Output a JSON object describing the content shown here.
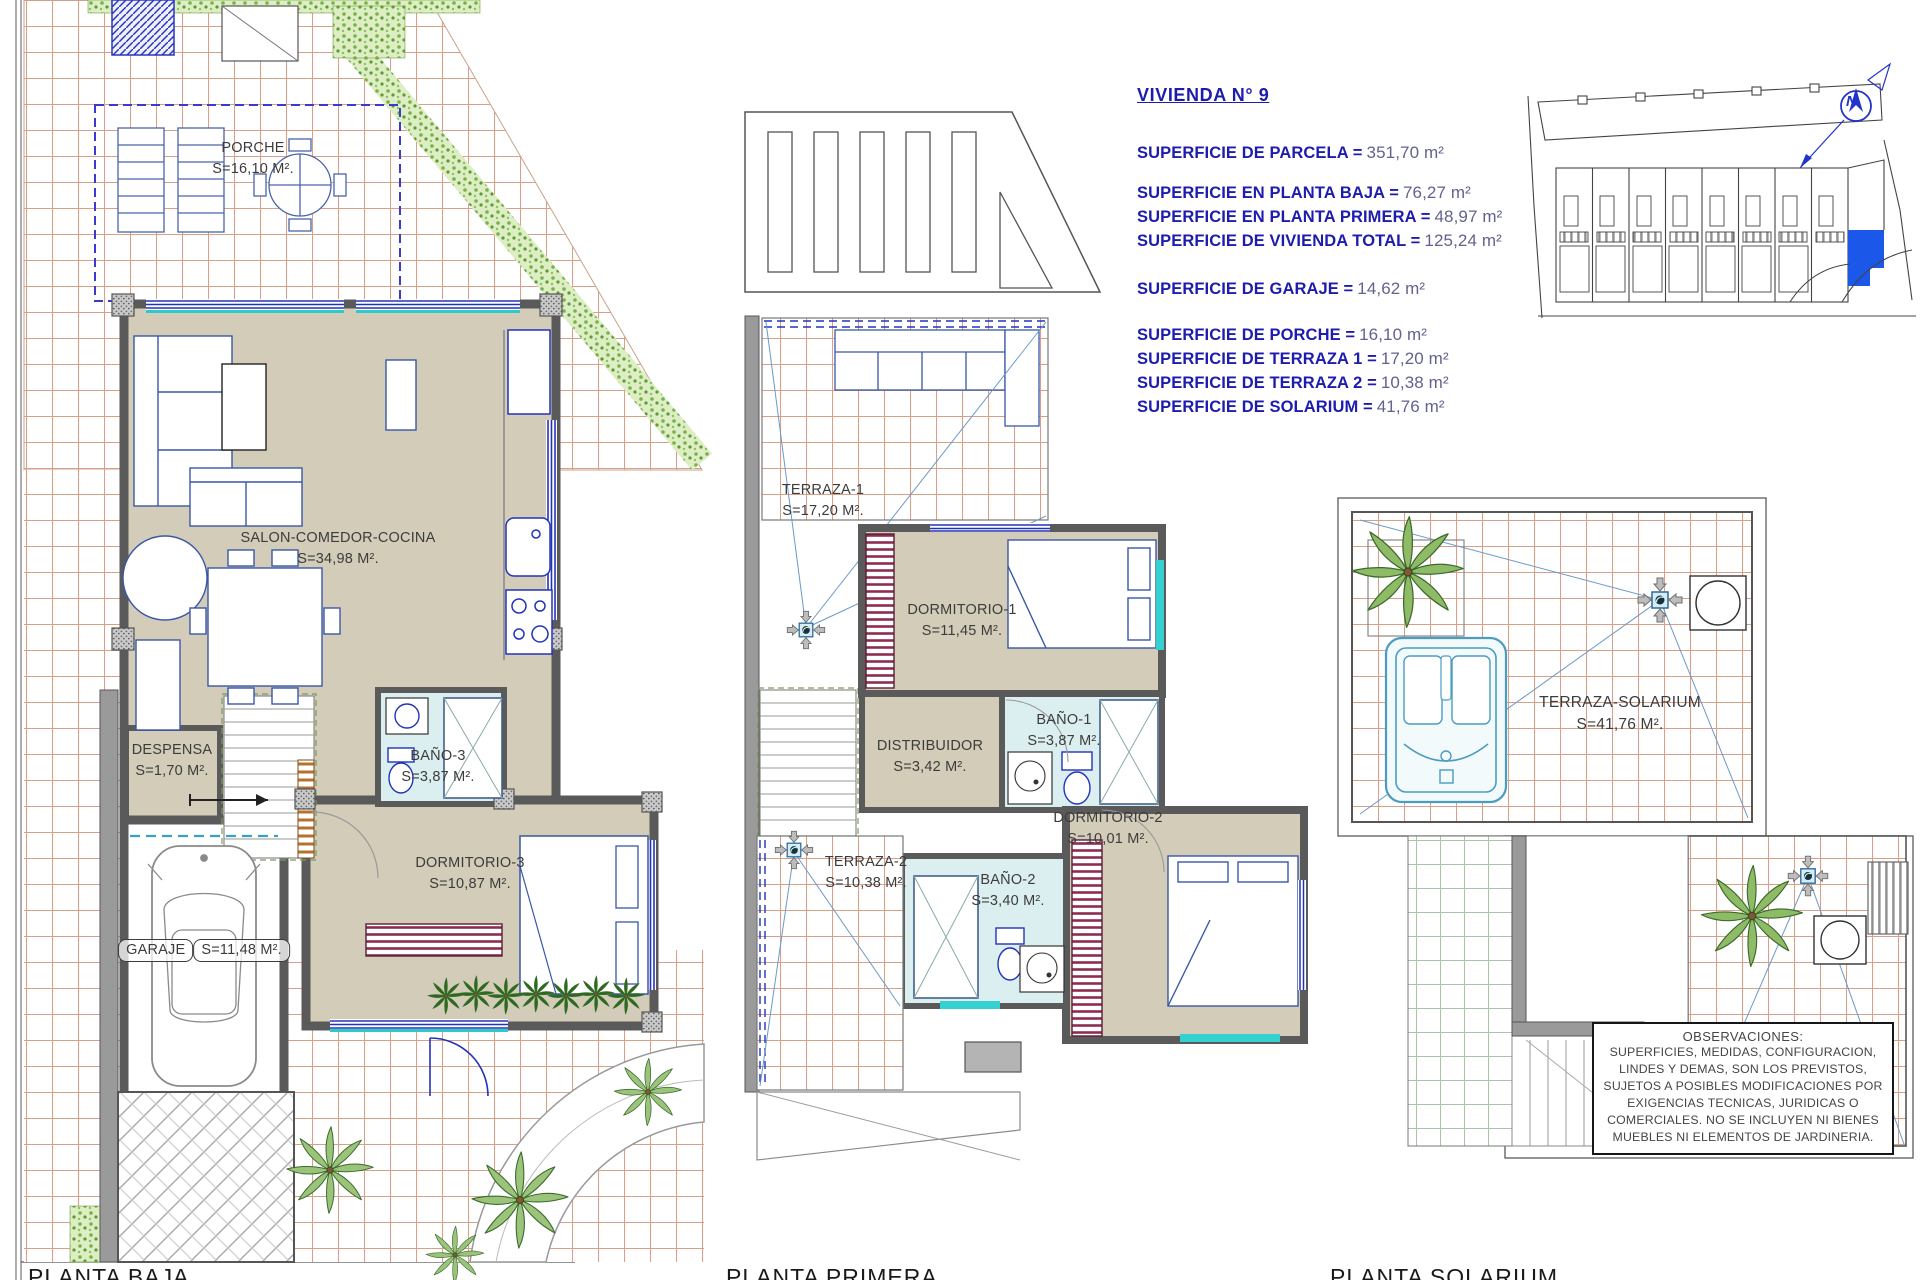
{
  "title_block": {
    "title": "VIVIENDA N° 9",
    "rows": [
      {
        "label": "SUPERFICIE DE PARCELA =",
        "value": "351,70 m²"
      },
      {
        "label": "SUPERFICIE EN PLANTA BAJA =",
        "value": "76,27 m²"
      },
      {
        "label": "SUPERFICIE EN PLANTA PRIMERA =",
        "value": "48,97 m²"
      },
      {
        "label": "SUPERFICIE DE VIVIENDA TOTAL =",
        "value": "125,24 m²"
      },
      {
        "label": "SUPERFICIE DE GARAJE =",
        "value": "14,62 m²"
      },
      {
        "label": "SUPERFICIE DE PORCHE =",
        "value": "16,10 m²"
      },
      {
        "label": "SUPERFICIE DE TERRAZA 1 =",
        "value": "17,20 m²"
      },
      {
        "label": "SUPERFICIE DE TERRAZA 2 =",
        "value": "10,38 m²"
      },
      {
        "label": "SUPERFICIE DE SOLARIUM =",
        "value": "41,76 m²"
      }
    ]
  },
  "plans": {
    "baja": {
      "caption": "PLANTA BAJA",
      "rooms": [
        {
          "name": "PORCHE",
          "area": "S=16,10 M²."
        },
        {
          "name": "SALON-COMEDOR-COCINA",
          "area": "S=34,98 M²."
        },
        {
          "name": "DESPENSA",
          "area": "S=1,70 M²."
        },
        {
          "name": "BAÑO-3",
          "area": "S=3,87 M²."
        },
        {
          "name": "DORMITORIO-3",
          "area": "S=10,87 M²."
        },
        {
          "name": "GARAJE",
          "area": "S=11,48 M²."
        }
      ]
    },
    "primera": {
      "caption": "PLANTA PRIMERA",
      "rooms": [
        {
          "name": "TERRAZA-1",
          "area": "S=17,20 M²."
        },
        {
          "name": "DORMITORIO-1",
          "area": "S=11,45 M²."
        },
        {
          "name": "DISTRIBUIDOR",
          "area": "S=3,42 M²."
        },
        {
          "name": "BAÑO-1",
          "area": "S=3,87 M²."
        },
        {
          "name": "DORMITORIO-2",
          "area": "S=10,01 M²."
        },
        {
          "name": "TERRAZA-2",
          "area": "S=10,38 M²."
        },
        {
          "name": "BAÑO-2",
          "area": "S=3,40 M²."
        }
      ]
    },
    "solarium": {
      "caption": "PLANTA SOLARIUM",
      "rooms": [
        {
          "name": "TERRAZA-SOLARIUM",
          "area": "S=41,76 M²."
        }
      ]
    }
  },
  "site_plan": {
    "north_label": "N"
  },
  "observations": {
    "title": "OBSERVACIONES:",
    "body": "SUPERFICIES, MEDIDAS, CONFIGURACION, LINDES Y DEMAS, SON LOS PREVISTOS, SUJETOS A POSIBLES MODIFICACIONES POR EXIGENCIAS TECNICAS, JURIDICAS O COMERCIALES. NO SE INCLUYEN NI BIENES MUEBLES NI ELEMENTOS DE JARDINERIA."
  },
  "colors": {
    "accent_blue": "#1d1cae",
    "value_gray": "#62628e",
    "wall_gray": "#5a5a5a",
    "floor_beige": "#d2ccb8",
    "bath_cyan": "#dbeff0",
    "window_blue": "#2233bb",
    "sill_cyan": "#2fc9c9",
    "tile_line": "#d8a088",
    "hedge_green": "#79b24b",
    "highlight_unit": "#1b57e8",
    "wardrobe_maroon": "#8e2c50"
  }
}
